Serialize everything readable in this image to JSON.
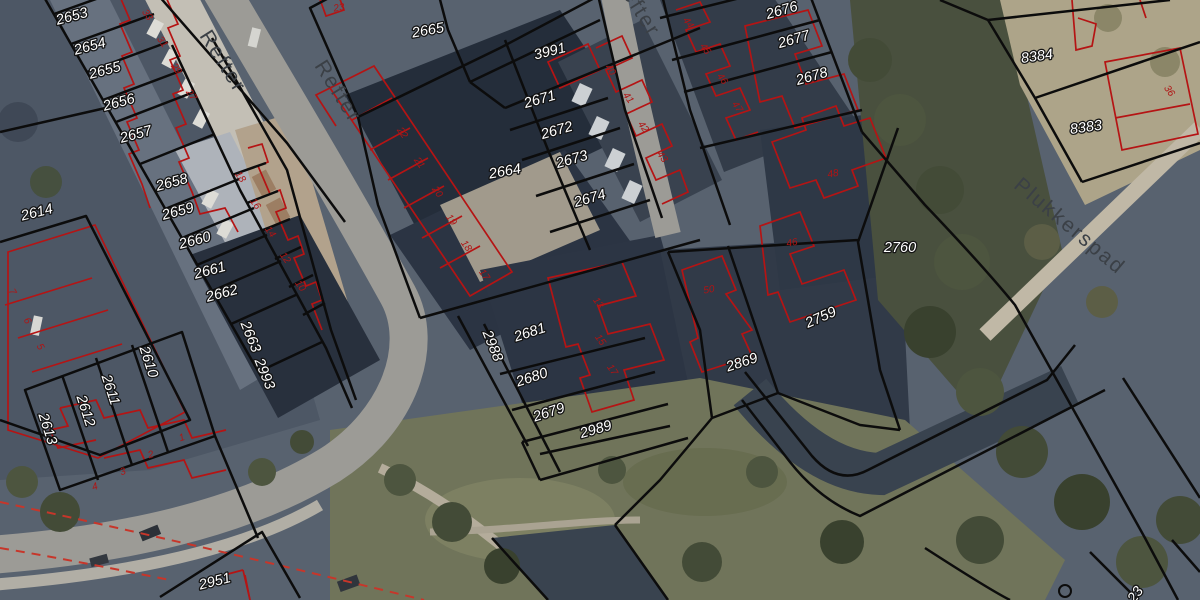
{
  "map": {
    "description": "Cadastral parcel overlay on aerial photograph",
    "colors": {
      "parcel_boundary": "#0c0c0c",
      "building_outline": "#b51414",
      "parcel_label_fill": "#ffffff",
      "parcel_label_halo": "#141414",
      "street_label": "#3b4046",
      "house_number": "#b01414",
      "road_marking": "#c7362a"
    },
    "streets": [
      {
        "id": "refter-1",
        "text": "Refter",
        "x": 222,
        "y": 62,
        "rot": 58
      },
      {
        "id": "refter-2",
        "text": "Refter",
        "x": 337,
        "y": 92,
        "rot": 58
      },
      {
        "id": "refter-3",
        "text": "Refter",
        "x": 636,
        "y": 6,
        "rot": 58
      },
      {
        "id": "plukkerspad",
        "text": "Plukkerspad",
        "x": 1069,
        "y": 227,
        "rot": 40
      }
    ],
    "parcels": [
      {
        "id": "2653",
        "text": "2653",
        "x": 72,
        "y": 17,
        "rot": -15
      },
      {
        "id": "2654",
        "text": "2654",
        "x": 90,
        "y": 47,
        "rot": -15
      },
      {
        "id": "2655",
        "text": "2655",
        "x": 105,
        "y": 71,
        "rot": -15
      },
      {
        "id": "2656",
        "text": "2656",
        "x": 119,
        "y": 103,
        "rot": -15
      },
      {
        "id": "2657",
        "text": "2657",
        "x": 136,
        "y": 135,
        "rot": -15
      },
      {
        "id": "2658",
        "text": "2658",
        "x": 172,
        "y": 183,
        "rot": -15
      },
      {
        "id": "2659",
        "text": "2659",
        "x": 178,
        "y": 212,
        "rot": -15
      },
      {
        "id": "2660",
        "text": "2660",
        "x": 195,
        "y": 241,
        "rot": -15
      },
      {
        "id": "2661",
        "text": "2661",
        "x": 210,
        "y": 271,
        "rot": -15
      },
      {
        "id": "2662",
        "text": "2662",
        "x": 222,
        "y": 294,
        "rot": -15
      },
      {
        "id": "2663",
        "text": "2663",
        "x": 250,
        "y": 337,
        "rot": 68
      },
      {
        "id": "2614",
        "text": "2614",
        "x": 37,
        "y": 213,
        "rot": -14
      },
      {
        "id": "2993",
        "text": "2993",
        "x": 264,
        "y": 374,
        "rot": 68
      },
      {
        "id": "2610",
        "text": "2610",
        "x": 148,
        "y": 362,
        "rot": 72
      },
      {
        "id": "2611",
        "text": "2611",
        "x": 110,
        "y": 390,
        "rot": 72
      },
      {
        "id": "2612",
        "text": "2612",
        "x": 85,
        "y": 411,
        "rot": 72
      },
      {
        "id": "2613",
        "text": "2613",
        "x": 47,
        "y": 429,
        "rot": 72
      },
      {
        "id": "2951",
        "text": "2951",
        "x": 215,
        "y": 582,
        "rot": -14
      },
      {
        "id": "2665",
        "text": "2665",
        "x": 428,
        "y": 31,
        "rot": -10
      },
      {
        "id": "3991",
        "text": "3991",
        "x": 550,
        "y": 52,
        "rot": -14
      },
      {
        "id": "2664",
        "text": "2664",
        "x": 505,
        "y": 172,
        "rot": -10
      },
      {
        "id": "2671",
        "text": "2671",
        "x": 540,
        "y": 100,
        "rot": -16
      },
      {
        "id": "2672",
        "text": "2672",
        "x": 557,
        "y": 131,
        "rot": -16
      },
      {
        "id": "2673",
        "text": "2673",
        "x": 572,
        "y": 160,
        "rot": -16
      },
      {
        "id": "2674",
        "text": "2674",
        "x": 590,
        "y": 199,
        "rot": -16
      },
      {
        "id": "2676",
        "text": "2676",
        "x": 782,
        "y": 11,
        "rot": -16
      },
      {
        "id": "2677",
        "text": "2677",
        "x": 794,
        "y": 40,
        "rot": -16
      },
      {
        "id": "2678",
        "text": "2678",
        "x": 812,
        "y": 77,
        "rot": -16
      },
      {
        "id": "2760",
        "text": "2760",
        "x": 900,
        "y": 248,
        "rot": 0
      },
      {
        "id": "2759",
        "text": "2759",
        "x": 821,
        "y": 318,
        "rot": -24
      },
      {
        "id": "2869",
        "text": "2869",
        "x": 742,
        "y": 363,
        "rot": -18
      },
      {
        "id": "2681",
        "text": "2681",
        "x": 530,
        "y": 333,
        "rot": -18
      },
      {
        "id": "2680",
        "text": "2680",
        "x": 532,
        "y": 378,
        "rot": -18
      },
      {
        "id": "2679",
        "text": "2679",
        "x": 549,
        "y": 413,
        "rot": -18
      },
      {
        "id": "2988",
        "text": "2988",
        "x": 492,
        "y": 346,
        "rot": 68
      },
      {
        "id": "2989",
        "text": "2989",
        "x": 596,
        "y": 430,
        "rot": -16
      },
      {
        "id": "8384",
        "text": "8384",
        "x": 1037,
        "y": 57,
        "rot": -8
      },
      {
        "id": "8383",
        "text": "8383",
        "x": 1086,
        "y": 128,
        "rot": -8
      },
      {
        "id": "23xx",
        "text": "23",
        "x": 1136,
        "y": 595,
        "rot": -55
      }
    ],
    "house_numbers": [
      {
        "id": "22",
        "text": "22",
        "x": 402,
        "y": 133,
        "rot": 55
      },
      {
        "id": "21",
        "text": "21",
        "x": 419,
        "y": 163,
        "rot": 55
      },
      {
        "id": "20",
        "text": "20",
        "x": 437,
        "y": 192,
        "rot": 55
      },
      {
        "id": "19",
        "text": "19",
        "x": 451,
        "y": 220,
        "rot": 55
      },
      {
        "id": "18a",
        "text": "18",
        "x": 466,
        "y": 246,
        "rot": 55
      },
      {
        "id": "17a",
        "text": "17",
        "x": 484,
        "y": 275,
        "rot": 55
      },
      {
        "id": "18b",
        "text": "18",
        "x": 240,
        "y": 177,
        "rot": 55
      },
      {
        "id": "16",
        "text": "16",
        "x": 255,
        "y": 204,
        "rot": 55
      },
      {
        "id": "14",
        "text": "14",
        "x": 270,
        "y": 232,
        "rot": 55
      },
      {
        "id": "12",
        "text": "12",
        "x": 285,
        "y": 258,
        "rot": 55
      },
      {
        "id": "10",
        "text": "10",
        "x": 300,
        "y": 286,
        "rot": 55
      },
      {
        "id": "33",
        "text": "33",
        "x": 147,
        "y": 15,
        "rot": 55
      },
      {
        "id": "31",
        "text": "31",
        "x": 162,
        "y": 42,
        "rot": 55
      },
      {
        "id": "29",
        "text": "29",
        "x": 176,
        "y": 69,
        "rot": 55
      },
      {
        "id": "27",
        "text": "27",
        "x": 191,
        "y": 95,
        "rot": 55
      },
      {
        "id": "7",
        "text": "7",
        "x": 12,
        "y": 292,
        "rot": 60
      },
      {
        "id": "6",
        "text": "6",
        "x": 27,
        "y": 321,
        "rot": 60
      },
      {
        "id": "5",
        "text": "5",
        "x": 40,
        "y": 347,
        "rot": 60
      },
      {
        "id": "1",
        "text": "1",
        "x": 182,
        "y": 438,
        "rot": -18
      },
      {
        "id": "2",
        "text": "2",
        "x": 151,
        "y": 455,
        "rot": -18
      },
      {
        "id": "3",
        "text": "3",
        "x": 123,
        "y": 472,
        "rot": -18
      },
      {
        "id": "4",
        "text": "4",
        "x": 95,
        "y": 487,
        "rot": -18
      },
      {
        "id": "40",
        "text": "40",
        "x": 610,
        "y": 70,
        "rot": 55
      },
      {
        "id": "41",
        "text": "41",
        "x": 628,
        "y": 98,
        "rot": 55
      },
      {
        "id": "42",
        "text": "42",
        "x": 643,
        "y": 127,
        "rot": 55
      },
      {
        "id": "43",
        "text": "43",
        "x": 662,
        "y": 157,
        "rot": 55
      },
      {
        "id": "44",
        "text": "44",
        "x": 688,
        "y": 23,
        "rot": 55
      },
      {
        "id": "45",
        "text": "45",
        "x": 705,
        "y": 49,
        "rot": 55
      },
      {
        "id": "46a",
        "text": "46",
        "x": 722,
        "y": 79,
        "rot": 55
      },
      {
        "id": "47",
        "text": "47",
        "x": 737,
        "y": 107,
        "rot": 55
      },
      {
        "id": "48",
        "text": "48",
        "x": 833,
        "y": 174,
        "rot": -10
      },
      {
        "id": "46b",
        "text": "46",
        "x": 792,
        "y": 243,
        "rot": -10
      },
      {
        "id": "50",
        "text": "50",
        "x": 709,
        "y": 290,
        "rot": -10
      },
      {
        "id": "13",
        "text": "13",
        "x": 598,
        "y": 303,
        "rot": 55
      },
      {
        "id": "15",
        "text": "15",
        "x": 600,
        "y": 340,
        "rot": 55
      },
      {
        "id": "17b",
        "text": "17",
        "x": 612,
        "y": 370,
        "rot": 55
      },
      {
        "id": "36",
        "text": "36",
        "x": 1169,
        "y": 91,
        "rot": 55
      },
      {
        "id": "23",
        "text": "23",
        "x": 339,
        "y": 8,
        "rot": -10
      }
    ]
  }
}
